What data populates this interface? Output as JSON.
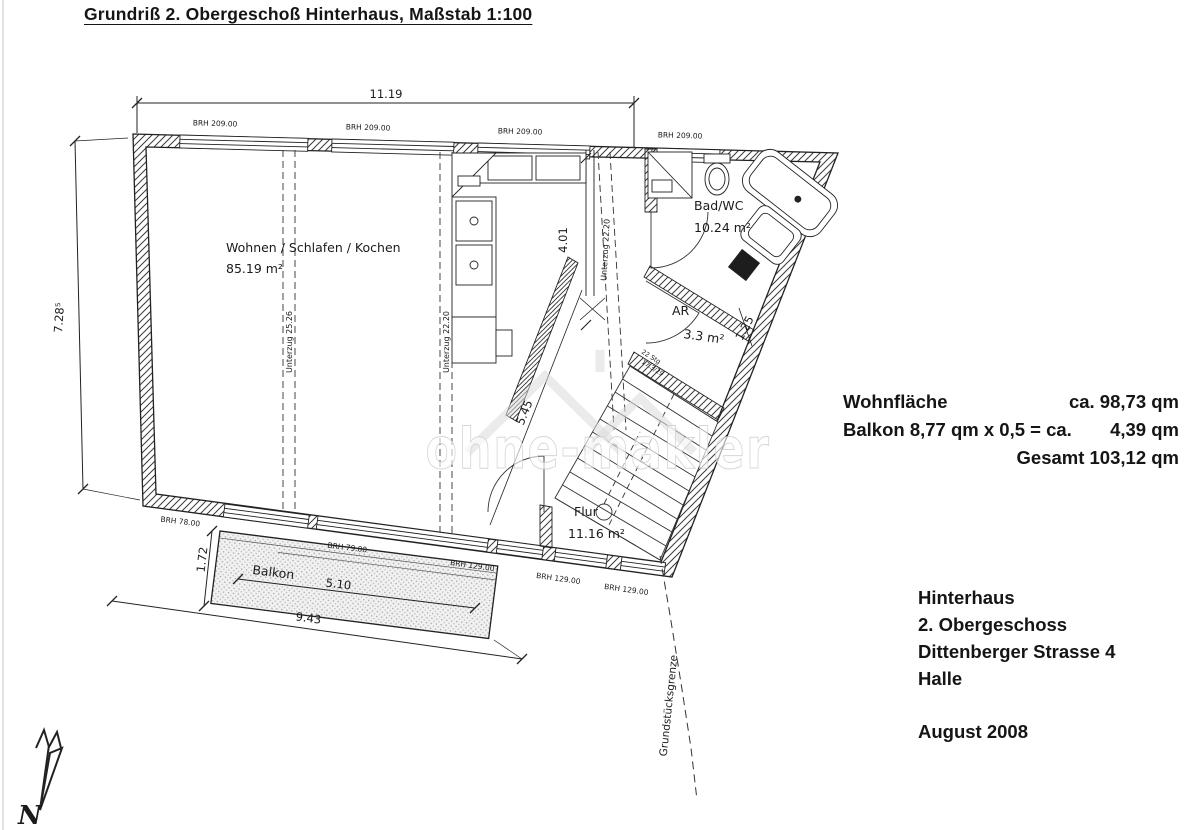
{
  "title": "Grundriß 2. Obergeschoß Hinterhaus, Maßstab 1:100",
  "watermark_text": "ohne-makler",
  "summary": {
    "label": "Wohnfläche",
    "value": "ca. 98,73 qm",
    "line2_label": "Balkon 8,77 qm x 0,5 = ca.",
    "line2_value": "4,39 qm",
    "total": "Gesamt 103,12 qm"
  },
  "address": {
    "line1": "Hinterhaus",
    "line2": "2. Obergeschoss",
    "line3": "Dittenberger Strasse 4",
    "line4": "Halle",
    "date": "August 2008"
  },
  "plan": {
    "rooms": {
      "living_name": "Wohnen / Schlafen / Kochen",
      "living_area": "85.19 m²",
      "bath_name": "Bad/WC",
      "bath_area": "10.24 m²",
      "storage_name": "AR",
      "storage_area": "3.3 m²",
      "hall_name": "Flur",
      "hall_area": "11.16 m²",
      "balcony_name": "Balkon"
    },
    "dimensions": {
      "top_width": "11.19",
      "left_height": "7.28⁵",
      "kitchen": "4.01",
      "diagonal": "5.45",
      "storage": "1.25",
      "balcony_depth": "1.72",
      "balcony_width": "5.10",
      "balcony_total": "9.43"
    },
    "windows_top": [
      "BRH 209.00",
      "BRH 209.00",
      "BRH 209.00",
      "BRH 209.00"
    ],
    "windows_bottom": [
      "BRH 78.00",
      "BRH 79.00",
      "BRH 129.00",
      "BRH 129.00",
      "BRH 129.00"
    ],
    "beams": [
      "Unterzug 25.26",
      "Unterzug 22.20",
      "Unterzug 22.20"
    ],
    "stairs": {
      "line1": "22 Stg",
      "line2": "17.3/29"
    },
    "boundary": "Grundstücksgrenze",
    "north": "N"
  }
}
